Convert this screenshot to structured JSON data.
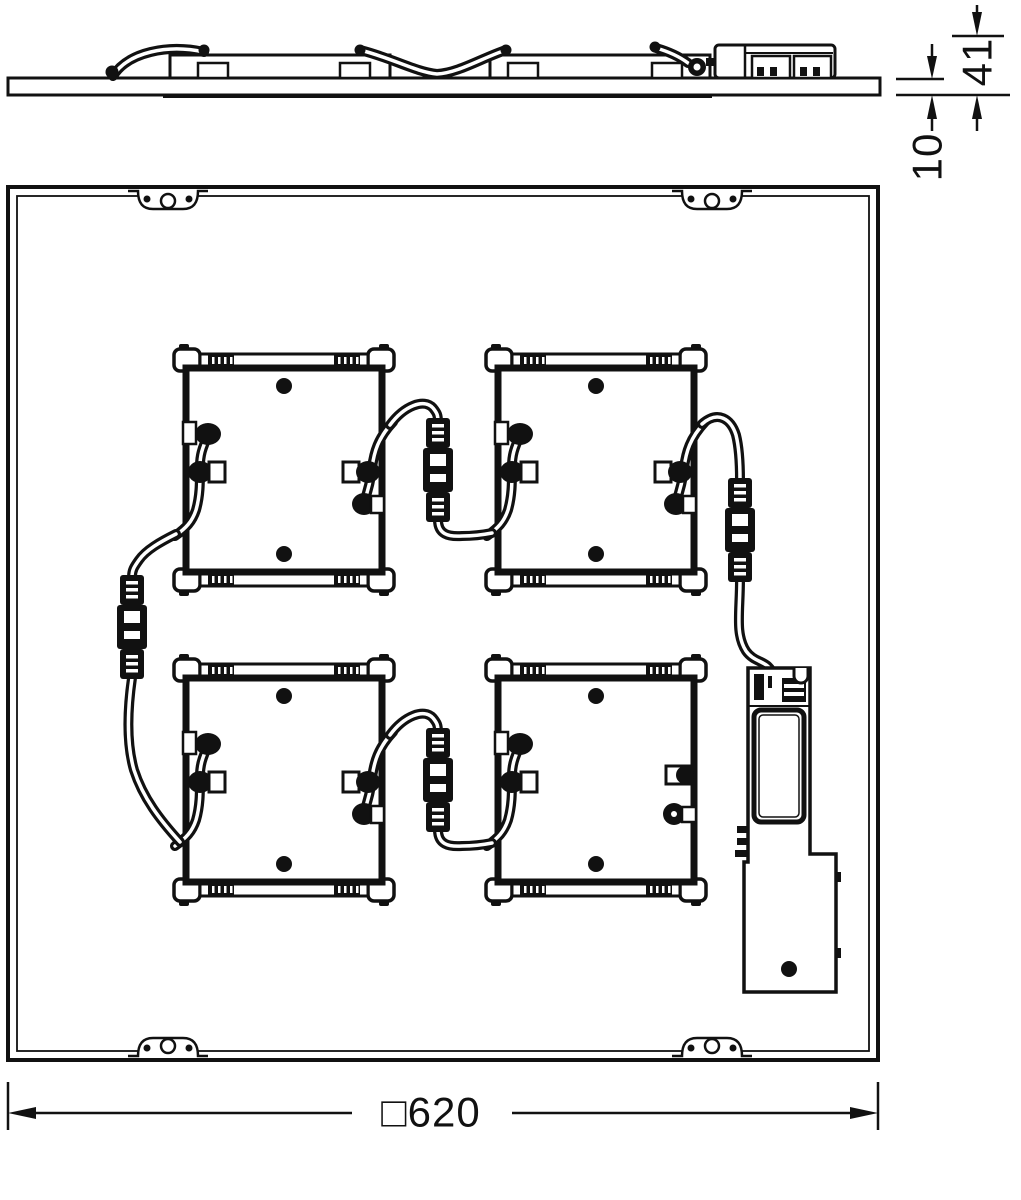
{
  "drawing": {
    "dimension_labels": {
      "total_height_mm": "41",
      "panel_thickness_mm": "10",
      "outer_size_mm": "□620"
    },
    "colors": {
      "line": "#111111",
      "background": "#ffffff"
    }
  }
}
